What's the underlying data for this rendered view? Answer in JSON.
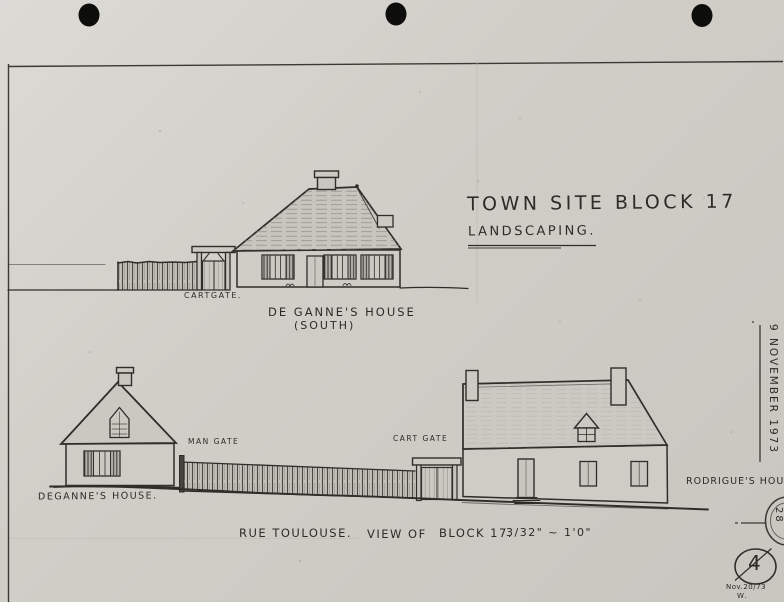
{
  "sheet": {
    "title": {
      "line1": "TOWN SITE BLOCK 17",
      "line2": "LANDSCAPING."
    },
    "top_elevation": {
      "gate_label": "CARTGATE.",
      "caption_line1": "DE GANNE'S HOUSE",
      "caption_line2": "(SOUTH)"
    },
    "street_elevation": {
      "left_house_label": "DEGANNE'S HOUSE.",
      "man_gate_label": "MAN GATE",
      "cart_gate_label": "CART GATE",
      "right_house_label": "RODRIGUE'S HOUS"
    },
    "caption": {
      "street": "RUE TOULOUSE.",
      "view": "VIEW OF",
      "block": "BLOCK 17.",
      "scale": "3/32\" ~ 1'0\""
    },
    "margin_notes": {
      "date_vertical": "9 NOVEMBER 1973",
      "sheet_number": "4",
      "revision_date": "Nov.20/73",
      "revision_initials": "W.",
      "detail_marker": "28"
    },
    "colors": {
      "paper": "#d1cec8",
      "ink": "#2d2b27",
      "pencil": "#54514b"
    }
  }
}
